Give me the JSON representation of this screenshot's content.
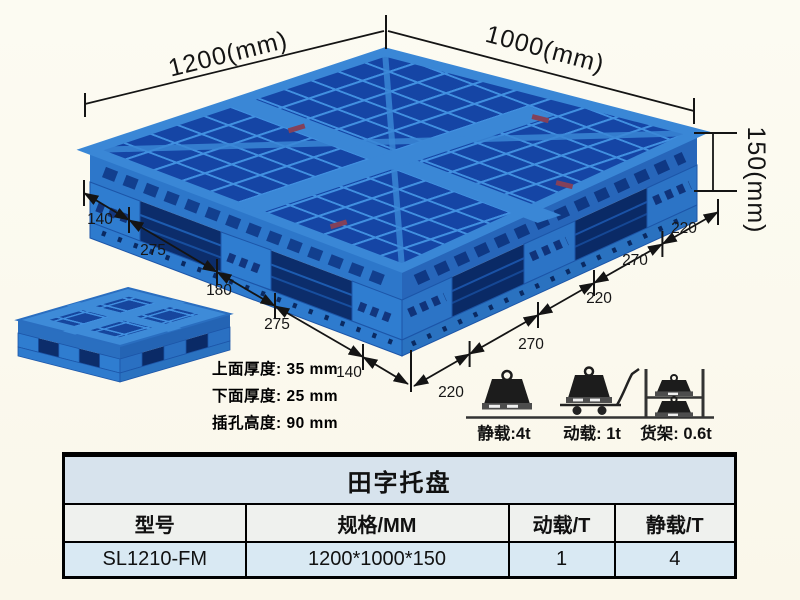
{
  "illustration": {
    "dim_top_left": "1200(mm)",
    "dim_top_right": "1000(mm)",
    "dim_height": "150(mm)",
    "left_edge_dims": [
      "140",
      "275",
      "180",
      "275",
      "140"
    ],
    "right_edge_dims": [
      "220",
      "270",
      "220",
      "270",
      "220"
    ],
    "thickness_notes": [
      "上面厚度: 35 mm",
      "下面厚度: 25 mm",
      "插孔高度: 90 mm"
    ]
  },
  "load_ratings": {
    "static": {
      "label": "静载:4t",
      "icon": "static-load-weight-icon"
    },
    "dynamic": {
      "label": "动载: 1t",
      "icon": "dynamic-load-trolley-icon"
    },
    "rack": {
      "label": "货架: 0.6t",
      "icon": "rack-load-icon"
    }
  },
  "table": {
    "title": "田字托盘",
    "headers": [
      "型号",
      "规格/MM",
      "动载/T",
      "静载/T"
    ],
    "row": [
      "SL1210-FM",
      "1200*1000*150",
      "1",
      "4"
    ]
  },
  "colors": {
    "pallet_light_blue": "#3a87d6",
    "pallet_mesh_hole": "#1545a5",
    "pallet_side_dark": "#0c2d6b",
    "table_title_bg": "#d7e3ed",
    "table_header_bg": "#eff1ee",
    "table_data_bg": "#d9e9f3",
    "background": "#fbfaf0",
    "line_color": "#141414"
  }
}
